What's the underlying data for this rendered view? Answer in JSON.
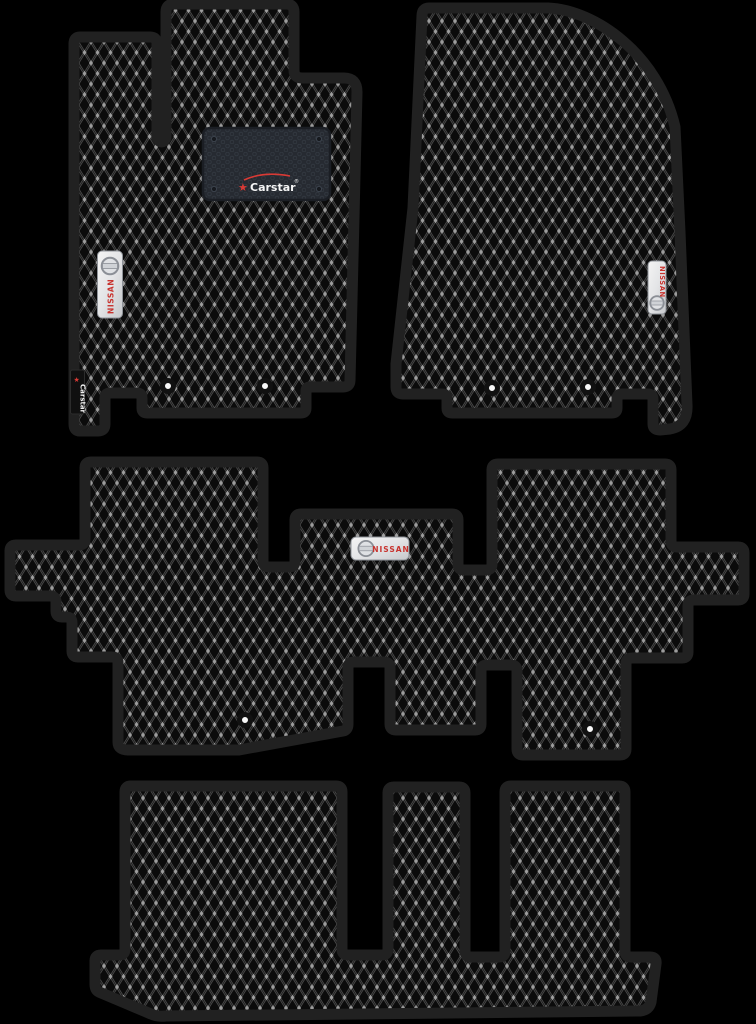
{
  "scene": {
    "background_color": "#000000",
    "pieces_visible": 4
  },
  "branding": {
    "heel_pad_logo_text": "Carstar",
    "heel_pad_logo_reg": "®",
    "edge_tag_text": "Carstar",
    "nissan_badge_text": "NISSAN",
    "brand_red": "#d93a35",
    "nissan_text_red": "#c8332e",
    "badge_silver": "#ebebeb"
  },
  "pattern": {
    "style": "eva-rhombus-mesh",
    "mat_base_color": "#0b0b0b",
    "mesh_line_color": "#4c4c4c",
    "mesh_dot_color": "#9d9d9d",
    "edge_trim_color": "#212121",
    "heel_pad_color": "#262a31"
  },
  "mats": [
    {
      "name": "front-driver",
      "position": "top-left",
      "badge": "NISSAN",
      "heel_pad": true,
      "edge_tag": "Carstar",
      "fastener_holes": 2
    },
    {
      "name": "front-passenger",
      "position": "top-right",
      "badge": "NISSAN",
      "heel_pad": false,
      "edge_tag": null,
      "fastener_holes": 2
    },
    {
      "name": "second-row",
      "position": "middle",
      "badge": "NISSAN",
      "heel_pad": false,
      "edge_tag": null,
      "fastener_holes": 2
    },
    {
      "name": "third-row-trunk",
      "position": "bottom",
      "badge": null,
      "heel_pad": false,
      "edge_tag": null,
      "fastener_holes": 0
    }
  ]
}
